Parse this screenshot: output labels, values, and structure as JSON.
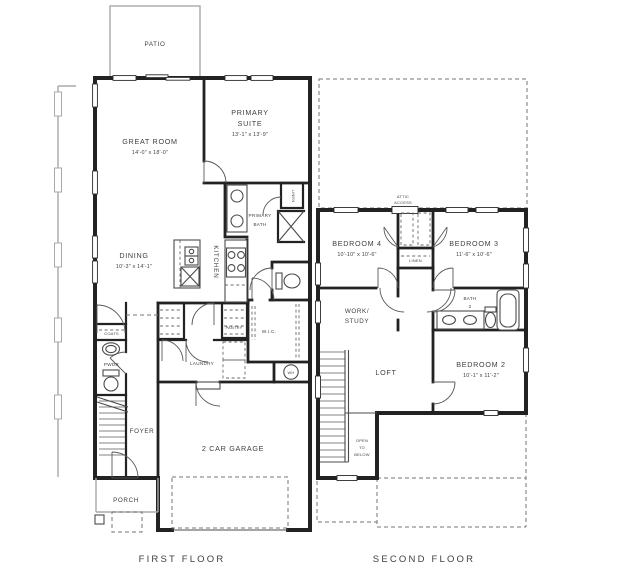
{
  "floorplan": {
    "first_floor": {
      "title": "FIRST FLOOR",
      "patio": "PATIO",
      "great_room": {
        "name": "GREAT ROOM",
        "dims": "14'-0\" x 18'-0\""
      },
      "primary_suite": {
        "line1": "PRIMARY",
        "line2": "SUITE",
        "dims": "13'-1\" x 13'-9\""
      },
      "primary_bath": {
        "line1": "PRIMARY",
        "line2": "BATH"
      },
      "dining": {
        "name": "DINING",
        "dims": "10'-3\" x 14'-1\""
      },
      "kitchen": "KITCHEN",
      "linen": "LINEN",
      "pantry": "PANTRY",
      "wic": "W.I.C.",
      "laundry": "LAUNDRY",
      "coats": "COATS",
      "powder": "PWDR",
      "foyer": "FOYER",
      "garage": "2 CAR GARAGE",
      "porch": "PORCH",
      "water_heater": "WH"
    },
    "second_floor": {
      "title": "SECOND FLOOR",
      "attic": {
        "line1": "ATTIC",
        "line2": "ACCESS"
      },
      "bedroom4": {
        "name": "BEDROOM 4",
        "dims": "10'-10\" x 10'-6\""
      },
      "bedroom3": {
        "name": "BEDROOM 3",
        "dims": "11'-6\" x 10'-6\""
      },
      "linen": "LINEN",
      "work_study": {
        "line1": "WORK/",
        "line2": "STUDY"
      },
      "bath2": {
        "line1": "BATH",
        "line2": "2"
      },
      "loft": "LOFT",
      "bedroom2": {
        "name": "BEDROOM 2",
        "dims": "10'-1\" x 11'-2\""
      },
      "open_to_below": {
        "line1": "OPEN",
        "line2": "TO",
        "line3": "BELOW"
      }
    },
    "colors": {
      "wall": "#222222",
      "thin_line": "#4b4b4b",
      "muted_gray": "#a9a9a9",
      "dashed_line": "#767676",
      "text": "#3f3f3f"
    }
  }
}
